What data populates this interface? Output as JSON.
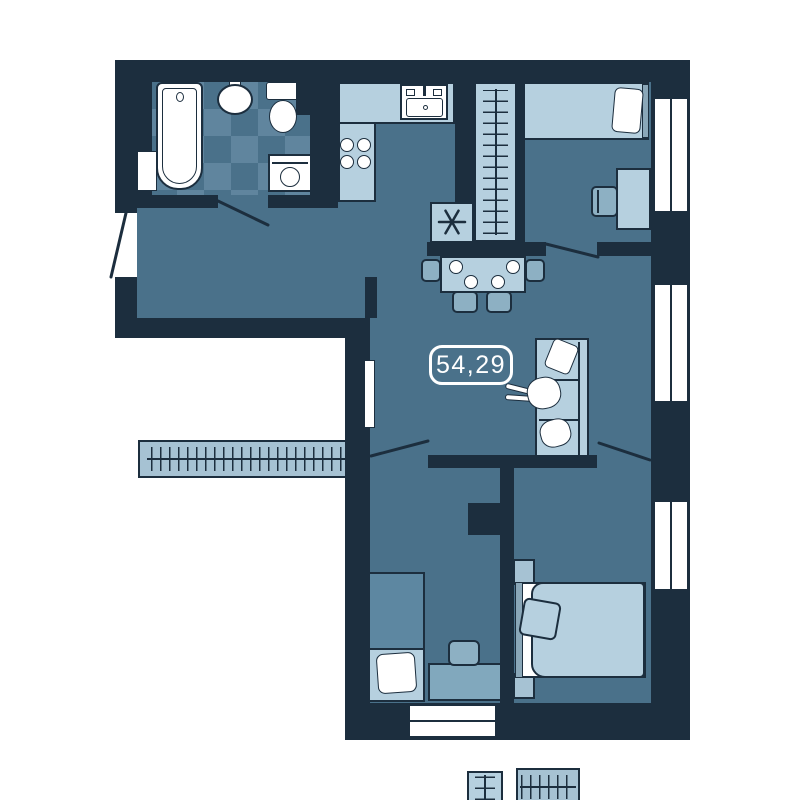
{
  "plan": {
    "area_label": "54,29",
    "vent_symbol": "asterisk"
  },
  "colors": {
    "wall": "#1c2e3e",
    "floor": "#4a718a",
    "tile": "#60859e",
    "light": "#b6d0df",
    "mid": "#a6c2d3",
    "chair": "#8db0c3",
    "desk": "#81a8bd",
    "blanket": "#5d87a1",
    "headboard": "#8aa7b8",
    "white": "#ffffff"
  },
  "rooms": [
    {
      "name": "bathroom",
      "items": [
        "bathtub",
        "washbasin",
        "toilet",
        "washing-machine",
        "towel-radiator",
        "checkered-tile-floor",
        "door-swing"
      ]
    },
    {
      "name": "hallway",
      "items": [
        "entrance-door-swing",
        "wardrobe-with-hangers"
      ]
    },
    {
      "name": "kitchen",
      "items": [
        "l-shaped-counter",
        "kitchen-sink",
        "cooktop-four-burners",
        "vent-shaft-asterisk"
      ]
    },
    {
      "name": "living-dining",
      "items": [
        "dining-table",
        "four-plates",
        "four-chairs",
        "sofa",
        "person-lying",
        "cushion",
        "pet",
        "radiator",
        "window",
        "area-label"
      ]
    },
    {
      "name": "bedroom-top-right",
      "items": [
        "single-bed",
        "pillow",
        "headboard",
        "desk",
        "chair",
        "built-in-wardrobe-hangers",
        "window",
        "door-swing"
      ]
    },
    {
      "name": "bedroom-bottom-left",
      "items": [
        "single-bed",
        "pillow",
        "blanket",
        "desk",
        "chair",
        "closet-hangers",
        "side-wardrobe-hangers",
        "window",
        "door-swing"
      ]
    },
    {
      "name": "bedroom-bottom-right",
      "items": [
        "double-bed",
        "pillow",
        "blanket",
        "two-nightstands",
        "closet-hangers",
        "window",
        "door-swing"
      ]
    }
  ]
}
